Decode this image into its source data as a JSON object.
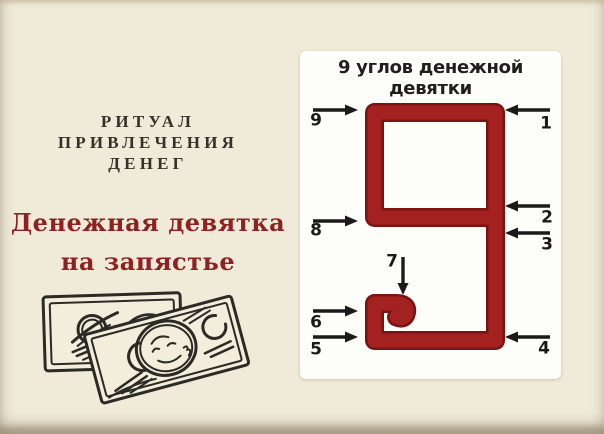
{
  "poster": {
    "ritual_title": {
      "lines": [
        "РИТУАЛ",
        "ПРИВЛЕЧЕНИЯ",
        "ДЕНЕГ"
      ]
    },
    "heading": {
      "lines": [
        "Денежная девятка",
        "на запястье"
      ]
    },
    "diagram": {
      "title_lines": [
        "9 углов денежной",
        "девятки"
      ],
      "corner_labels": [
        "1",
        "2",
        "3",
        "4",
        "5",
        "6",
        "7",
        "8",
        "9"
      ]
    },
    "icons": {
      "banknotes_sketch": "banknotes-sketch-icon"
    }
  },
  "colors": {
    "bg": "#f0ead9",
    "card-bg": "#fdfdfa",
    "nine-red": "#a32120",
    "nine-rim": "#7b1411",
    "heading-red": "#8e2122",
    "ink": "#2b2a25",
    "arrow-black": "#1b1a18",
    "text-dark": "#35312a",
    "note-fill": "#f3eddc"
  }
}
